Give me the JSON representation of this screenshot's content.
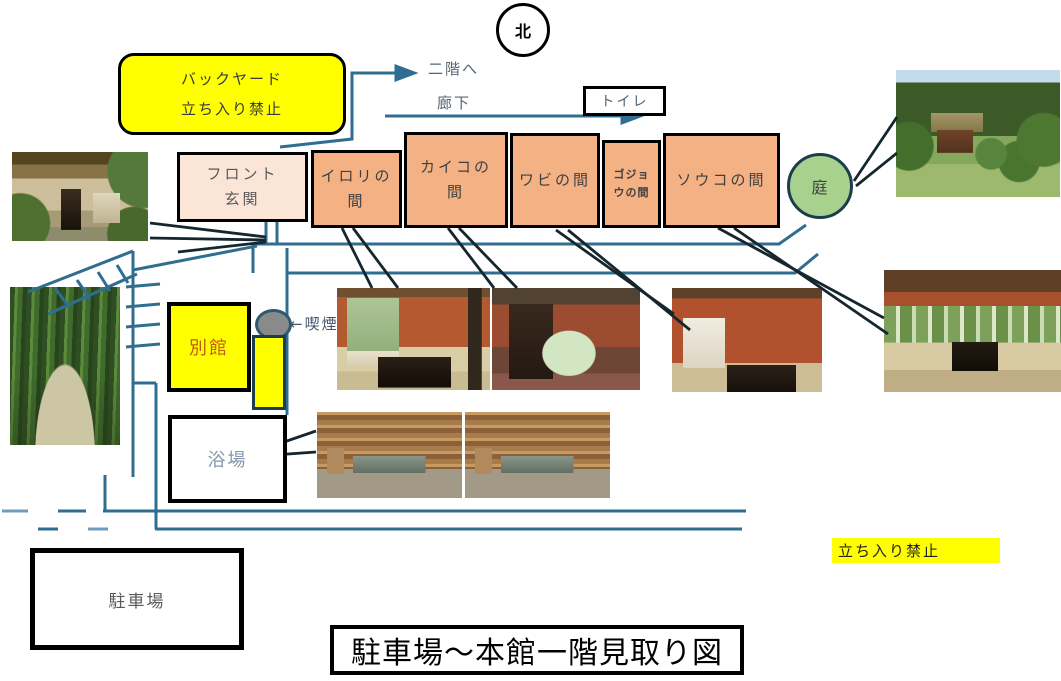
{
  "diagram_title": "駐車場～本館一階見取り図",
  "compass_label": "北",
  "backyard_sign": {
    "line1": "バックヤード",
    "line2": "立ち入り禁止"
  },
  "labels": {
    "to_second_floor": "二階へ",
    "corridor": "廊下",
    "toilet": "トイレ",
    "garden": "庭",
    "annex": "別館",
    "smoking": "←喫煙",
    "bath_house": "浴場",
    "parking_lot": "駐車場",
    "no_entry": "立ち入り禁止"
  },
  "rooms": [
    {
      "name": "front-entrance",
      "line1": "フロント",
      "line2": "玄関"
    },
    {
      "name": "irori-room",
      "line1": "イロリの",
      "line2": "間"
    },
    {
      "name": "kaiko-room",
      "line1": "カイコの",
      "line2": "間"
    },
    {
      "name": "wabi-room",
      "line1": "ワビの間",
      "line2": ""
    },
    {
      "name": "gojou-room",
      "line1": "ゴジョ",
      "line2": "ウの間"
    },
    {
      "name": "souko-room",
      "line1": "ソウコの間",
      "line2": ""
    }
  ],
  "photos": [
    {
      "name": "entrance-photo"
    },
    {
      "name": "bamboo-path-photo"
    },
    {
      "name": "garden-photo"
    },
    {
      "name": "irori-room-photo"
    },
    {
      "name": "dining-room-photo"
    },
    {
      "name": "wabi-room-photo"
    },
    {
      "name": "souko-room-photo"
    },
    {
      "name": "bath-photo-1"
    },
    {
      "name": "bath-photo-2"
    }
  ],
  "colors": {
    "room_fill": "#f4b183",
    "front_room_fill": "#fbe5d6",
    "highlight_yellow": "#ffff00",
    "garden_green": "#a9d18e",
    "path_teal": "#2f6e90",
    "pointer_dark": "#16262e"
  }
}
